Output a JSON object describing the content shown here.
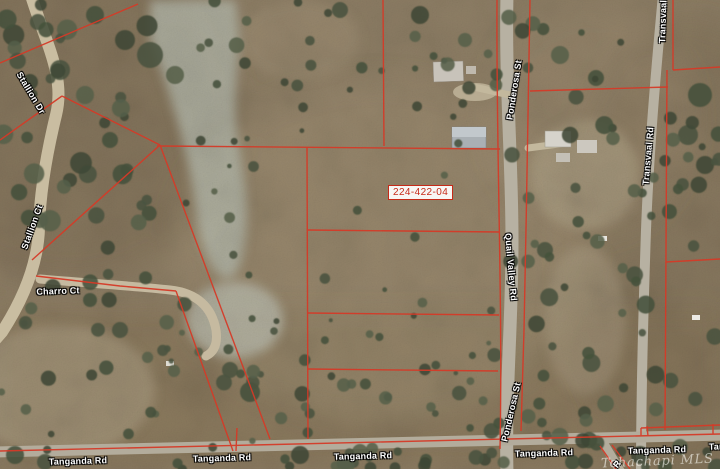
{
  "map": {
    "parcel_label": "224-422-04",
    "watermark": "Tehachapi MLS",
    "colors": {
      "parcel_line": "#d53a28",
      "road_label_text": "#ffffff",
      "parcel_label_text": "#c62a18",
      "parcel_label_bg": "rgba(255,255,255,0.93)"
    },
    "road_labels": [
      {
        "name": "stallion-dr",
        "text": "Stallion Dr"
      },
      {
        "name": "stallion-ct",
        "text": "Stallion Ct"
      },
      {
        "name": "charro-ct",
        "text": "Charro Ct"
      },
      {
        "name": "ponderosa-st-north",
        "text": "Ponderosa St"
      },
      {
        "name": "quail-valley-rd",
        "text": "Quail Valley Rd"
      },
      {
        "name": "ponderosa-st-south",
        "text": "Ponderosa St"
      },
      {
        "name": "transvaal-rd-north",
        "text": "Transvaal Rd"
      },
      {
        "name": "transvaal-rd-mid",
        "text": "Transvaal Rd"
      },
      {
        "name": "tanganda-rd-1",
        "text": "Tanganda Rd"
      },
      {
        "name": "tanganda-rd-2",
        "text": "Tanganda Rd"
      },
      {
        "name": "tanganda-rd-3",
        "text": "Tanganda Rd"
      },
      {
        "name": "tanganda-rd-4",
        "text": "Tanganda Rd"
      },
      {
        "name": "tanganda-rd-5",
        "text": "Tanganda Rd"
      },
      {
        "name": "tanganda-rd-6",
        "text": "Tanganda Rd"
      },
      {
        "name": "road-label-cutoff",
        "text": "R"
      }
    ]
  }
}
